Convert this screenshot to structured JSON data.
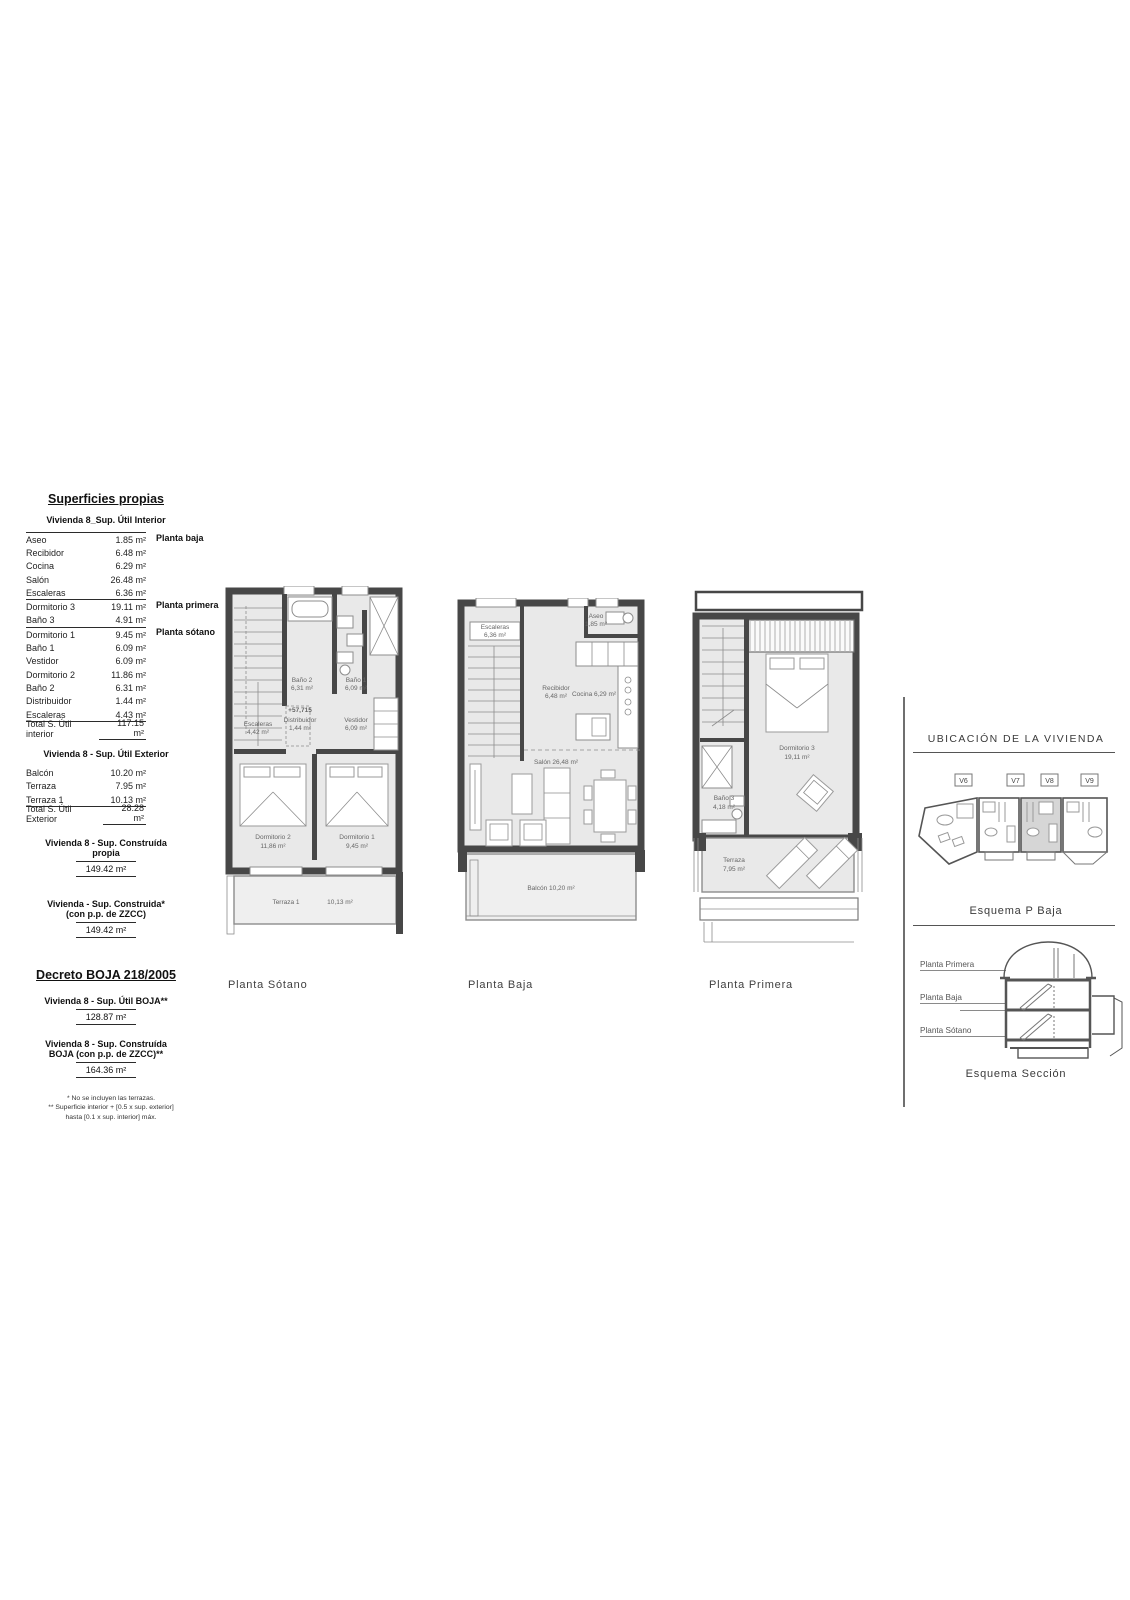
{
  "surfaces": {
    "title": "Superficies propias",
    "interior": {
      "subtitle": "Vivienda 8_Sup. Útil Interior",
      "rows": [
        {
          "label": "Aseo",
          "value": "1.85 m²"
        },
        {
          "label": "Recibidor",
          "value": "6.48 m²"
        },
        {
          "label": "Cocina",
          "value": "6.29 m²"
        },
        {
          "label": "Salón",
          "value": "26.48 m²"
        },
        {
          "label": "Escaleras",
          "value": "6.36 m²"
        },
        {
          "label": "Dormitorio 3",
          "value": "19.11 m²"
        },
        {
          "label": "Baño 3",
          "value": "4.91 m²"
        },
        {
          "label": "Dormitorio 1",
          "value": "9.45 m²"
        },
        {
          "label": "Baño 1",
          "value": "6.09 m²"
        },
        {
          "label": "Vestidor",
          "value": "6.09 m²"
        },
        {
          "label": "Dormitorio 2",
          "value": "11.86 m²"
        },
        {
          "label": "Baño 2",
          "value": "6.31 m²"
        },
        {
          "label": "Distribuidor",
          "value": "1.44 m²"
        },
        {
          "label": "Escaleras",
          "value": "4.43 m²"
        }
      ],
      "total_label": "Total S. Útil interior",
      "total_value": "117.15 m²",
      "side_labels": {
        "baja": "Planta baja",
        "primera": "Planta primera",
        "sotano": "Planta sótano"
      }
    },
    "exterior": {
      "subtitle": "Vivienda 8 - Sup. Útil Exterior",
      "rows": [
        {
          "label": "Balcón",
          "value": "10.20 m²"
        },
        {
          "label": "Terraza",
          "value": "7.95 m²"
        },
        {
          "label": "Terraza 1",
          "value": "10.13 m²"
        }
      ],
      "total_label": "Total S. Útil Exterior",
      "total_value": "28.28 m²"
    },
    "construida_propia": {
      "line1": "Vivienda 8 - Sup. Construída",
      "line2": "propia",
      "value": "149.42 m²"
    },
    "construida_zzcc": {
      "line1": "Vivienda - Sup. Construida*",
      "line2": "(con p.p. de ZZCC)",
      "value": "149.42 m²"
    }
  },
  "decreto": {
    "title": "Decreto BOJA 218/2005",
    "util_boja": {
      "line1": "Vivienda 8 - Sup. Útil BOJA**",
      "value": "128.87 m²"
    },
    "construida_boja": {
      "line1": "Vivienda 8 - Sup. Construída",
      "line2": "BOJA (con p.p. de ZZCC)**",
      "value": "164.36 m²"
    },
    "footnote1": "* No se incluyen las terrazas.",
    "footnote2a": "** Superficie interior + [0.5 x sup. exterior]",
    "footnote2b": "hasta [0.1 x sup. interior] máx."
  },
  "plans": {
    "sotano": {
      "caption": "Planta Sótano",
      "rooms": {
        "escaleras": "Escaleras",
        "escaleras_area": "4,42 m²",
        "bano2": "Baño 2",
        "bano2_area": "6,31 m²",
        "bano1": "Baño 1",
        "bano1_area": "6,09 m²",
        "level_mark": "+57,715",
        "distribuidor": "Distribuidor",
        "distribuidor_area": "1,44 m²",
        "vestidor": "Vestidor",
        "vestidor_area": "6,09 m²",
        "dormitorio2": "Dormitorio 2",
        "dormitorio2_area": "11,86 m²",
        "dormitorio1": "Dormitorio 1",
        "dormitorio1_area": "9,45 m²",
        "terraza1": "Terraza 1",
        "terraza1_area": "10,13 m²"
      }
    },
    "baja": {
      "caption": "Planta Baja",
      "rooms": {
        "escaleras": "Escaleras",
        "escaleras_area": "6,36 m²",
        "recibidor": "Recibidor",
        "recibidor_area": "6,48 m²",
        "aseo": "Aseo",
        "aseo_area": "1,85 m²",
        "cocina": "Cocina 6,29 m²",
        "salon": "Salón 26,48 m²",
        "balcon": "Balcón 10,20 m²"
      }
    },
    "primera": {
      "caption": "Planta Primera",
      "rooms": {
        "dormitorio3": "Dormitorio 3",
        "dormitorio3_area": "19,11 m²",
        "bano3": "Baño 3",
        "bano3_area": "4,18 m²",
        "terraza": "Terraza",
        "terraza_area": "7,95 m²"
      }
    }
  },
  "location_panel": {
    "title": "UBICACIÓN DE LA VIVIENDA",
    "units": [
      "V6",
      "V7",
      "V8",
      "V9"
    ],
    "caption_pbaja": "Esquema P Baja",
    "section_labels": [
      "Planta Primera",
      "Planta Baja",
      "Planta Sótano"
    ],
    "caption_seccion": "Esquema Sección"
  },
  "colors": {
    "wall": "#474747",
    "floor": "#e9e9e9",
    "highlight_unit": "#d6d6d6",
    "line": "#8d8d8d"
  }
}
